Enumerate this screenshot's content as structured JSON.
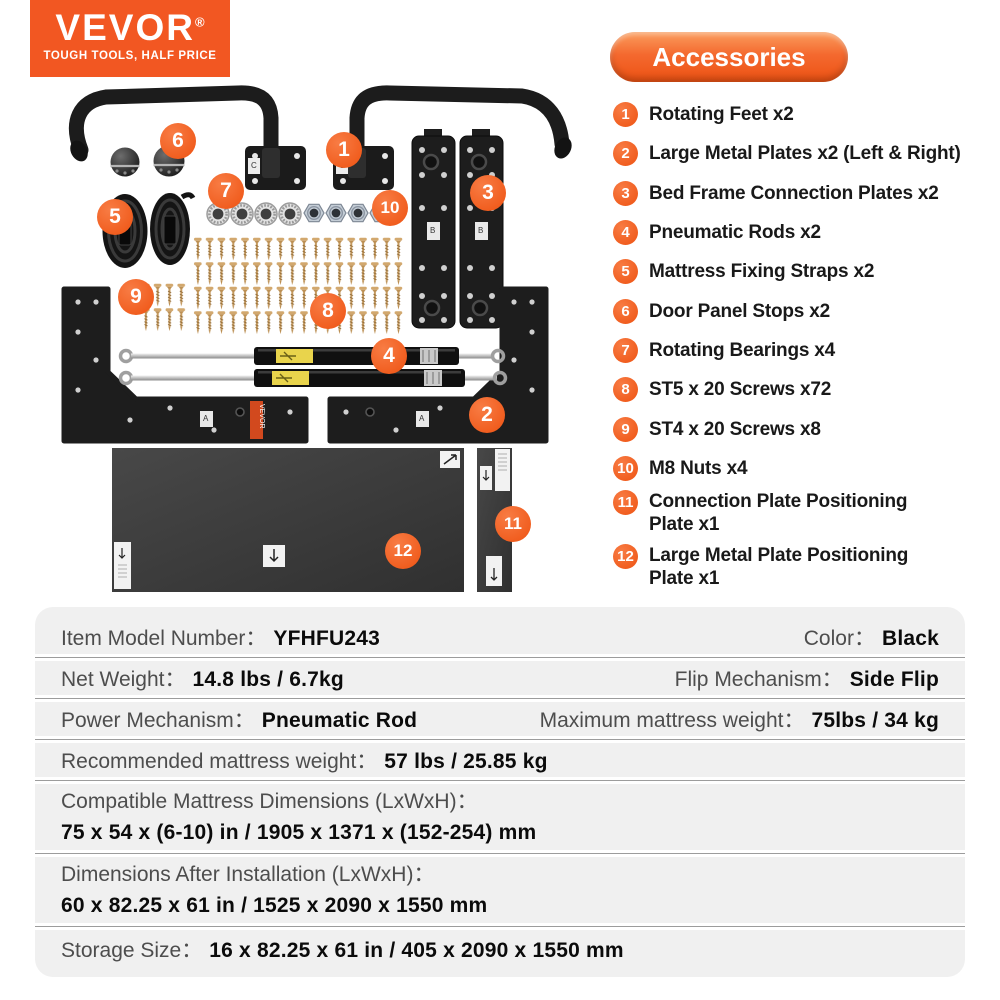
{
  "logo": {
    "brand": "VEVOR",
    "registered": "®",
    "tagline": "TOUGH TOOLS, HALF PRICE"
  },
  "accessories": {
    "title": "Accessories",
    "items": [
      {
        "number": "1",
        "label": "Rotating Feet x2"
      },
      {
        "number": "2",
        "label": "Large Metal Plates x2 (Left & Right)"
      },
      {
        "number": "3",
        "label": "Bed Frame Connection Plates x2"
      },
      {
        "number": "4",
        "label": "Pneumatic Rods x2"
      },
      {
        "number": "5",
        "label": "Mattress Fixing Straps x2"
      },
      {
        "number": "6",
        "label": "Door Panel Stops x2"
      },
      {
        "number": "7",
        "label": "Rotating Bearings x4"
      },
      {
        "number": "8",
        "label": "ST5 x 20 Screws x72"
      },
      {
        "number": "9",
        "label": "ST4 x 20 Screws x8"
      },
      {
        "number": "10",
        "label": "M8 Nuts x4"
      },
      {
        "number": "11",
        "label": "Connection Plate Positioning\nPlate x1"
      },
      {
        "number": "12",
        "label": "Large Metal Plate Positioning\nPlate x1"
      }
    ]
  },
  "parts": {
    "vevor_label": "VEVOR",
    "markings": {
      "feet": "C",
      "connection": "B",
      "large": "A"
    }
  },
  "specs": {
    "rows": [
      {
        "label": "Item Model Number：",
        "value": "YFHFU243",
        "label2": "Color：",
        "value2": "Black"
      },
      {
        "label": "Net Weight：",
        "value": "14.8 lbs / 6.7kg",
        "label2": "Flip Mechanism：",
        "value2": "Side Flip"
      },
      {
        "label": "Power Mechanism：",
        "value": "Pneumatic Rod",
        "label2": "Maximum mattress weight：",
        "value2": "75lbs / 34 kg"
      },
      {
        "label": "Recommended mattress weight：",
        "value": "57 lbs / 25.85 kg"
      },
      {
        "label": "Compatible Mattress Dimensions (LxWxH)：",
        "value": "75 x 54 x (6-10) in / 1905 x 1371 x (152-254) mm"
      },
      {
        "label": "Dimensions After Installation (LxWxH)：",
        "value": "60 x 82.25 x 61 in / 1525 x 2090 x 1550 mm"
      },
      {
        "label": "Storage Size：",
        "value": "16 x 82.25 x 61 in / 405 x 2090 x 1550 mm"
      }
    ]
  },
  "colors": {
    "brand_orange": "#F25722",
    "callout_orange": "#EE5211",
    "table_background": "#F0F0F0",
    "part_black": "#1D1D1D",
    "screw_gold": "#C59A5E"
  }
}
